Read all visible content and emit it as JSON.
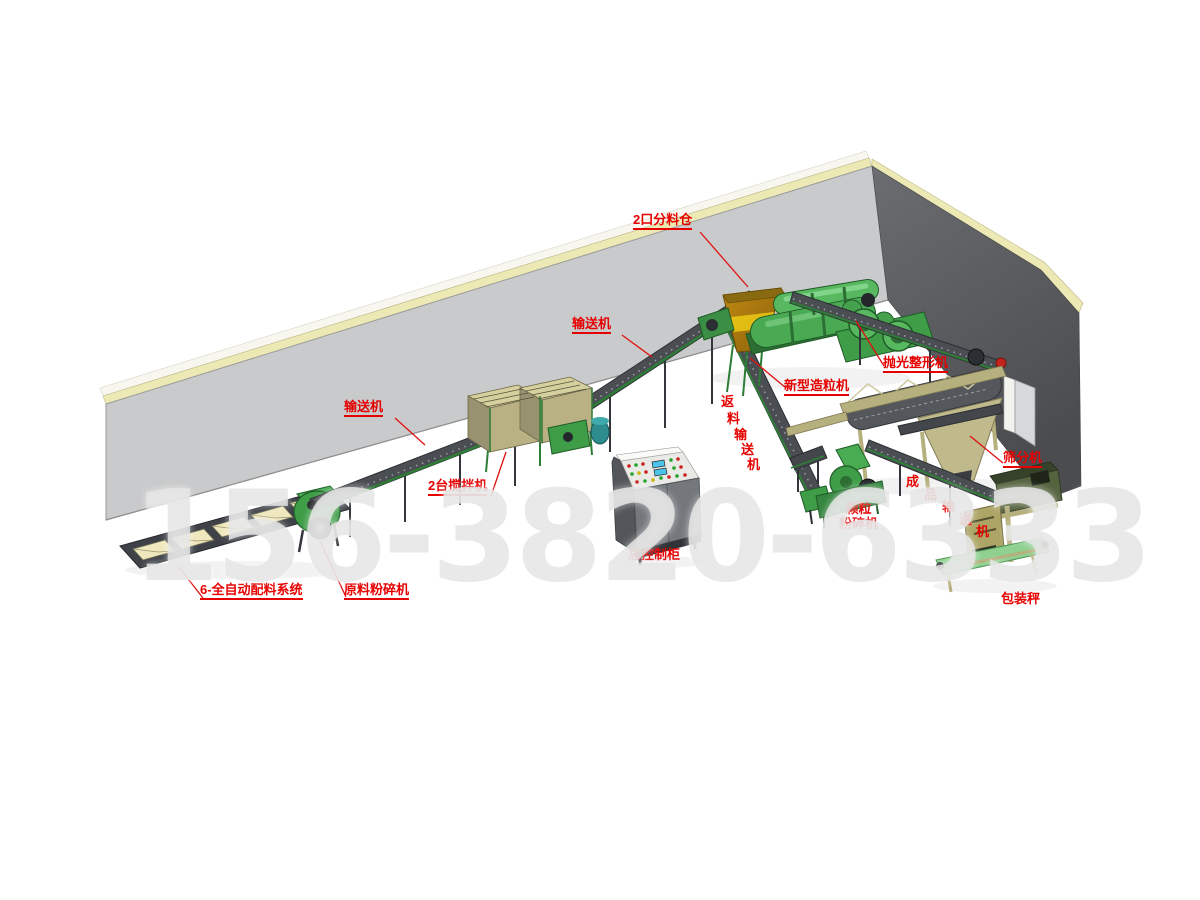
{
  "watermark": {
    "text": "156-3820-6333",
    "color": "#e9e9e9"
  },
  "scene": {
    "back_wall_color": "#c9cacb",
    "right_wall_color": "#56585b",
    "trim_color": "#ece9b4",
    "machine_green": "#3f9d48",
    "frame_khaki": "#b6af7e",
    "hopper_orange": "#b8860b",
    "label_color": "#e60000",
    "belt_color": "#4a4e53"
  },
  "labels": {
    "distribution_bin": {
      "text": "2口分料仓"
    },
    "conveyor_upper": {
      "text": "输送机"
    },
    "conveyor_lower": {
      "text": "输送机"
    },
    "mixers": {
      "text": "2台搅拌机"
    },
    "granulator": {
      "text": "新型造粒机"
    },
    "return_conveyor": {
      "chars": [
        "返",
        "料",
        "输",
        "送",
        "机"
      ]
    },
    "polisher": {
      "text": "抛光整形机"
    },
    "screener": {
      "text": "筛分机"
    },
    "product_conveyor": {
      "chars": [
        "成",
        "品",
        "输",
        "送",
        "机"
      ]
    },
    "pellet_crusher": {
      "line1": "颗粒",
      "line2": "粉碎机"
    },
    "control_cabinet": {
      "text": "总控制柜"
    },
    "batching_system": {
      "text": "6-全自动配料系统"
    },
    "raw_crusher": {
      "text": "原料粉碎机"
    },
    "packing_scale": {
      "text": "包装秤"
    }
  }
}
